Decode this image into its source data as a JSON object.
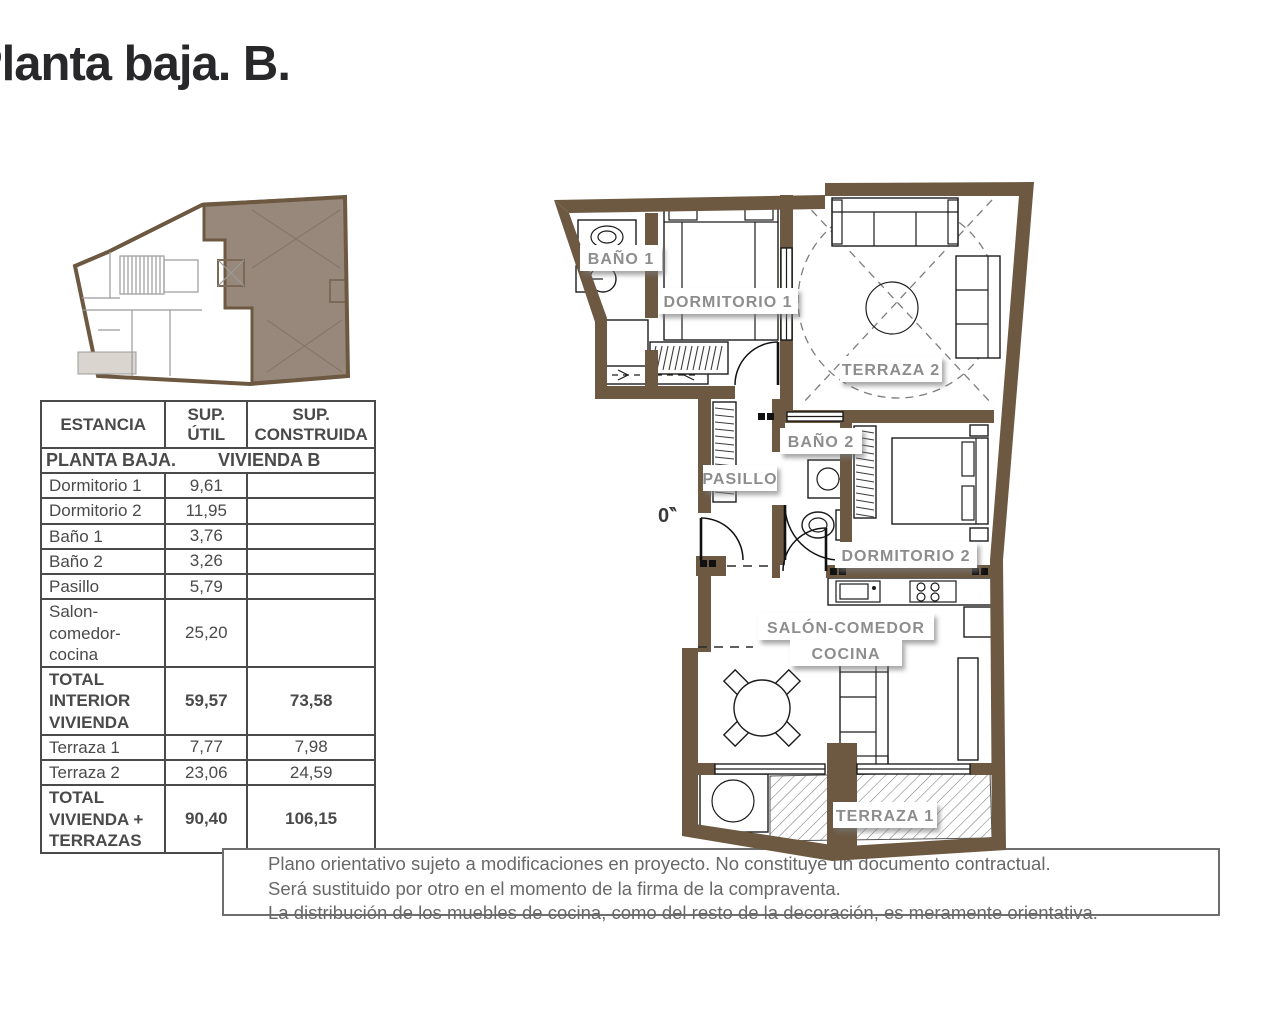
{
  "title": "Planta baja. B.",
  "colors": {
    "wall_brown": "#6d5942",
    "unit_highlight": "#98887b",
    "room_label_gray": "#8d8d8d",
    "table_ink": "#4a4a4a",
    "title_ink": "#28282a",
    "disclaimer_ink": "#686868"
  },
  "table": {
    "headers": {
      "estancia": "ESTANCIA",
      "util": "SUP.\nÚTIL",
      "construida": "SUP.\nCONSTRUIDA"
    },
    "section_title": "PLANTA BAJA.",
    "section_subtitle": "VIVIENDA B",
    "rows": [
      {
        "estancia": "Dormitorio 1",
        "util": "9,61",
        "construida": ""
      },
      {
        "estancia": "Dormitorio 2",
        "util": "11,95",
        "construida": ""
      },
      {
        "estancia": "Baño 1",
        "util": "3,76",
        "construida": ""
      },
      {
        "estancia": "Baño 2",
        "util": "3,26",
        "construida": ""
      },
      {
        "estancia": "Pasillo",
        "util": "5,79",
        "construida": ""
      },
      {
        "estancia": "Salon-\ncomedor-\ncocina",
        "util": "25,20",
        "construida": ""
      },
      {
        "estancia": "TOTAL\nINTERIOR\nVIVIENDA",
        "util": "59,57",
        "construida": "73,58"
      },
      {
        "estancia": "Terraza 1",
        "util": "7,77",
        "construida": "7,98"
      },
      {
        "estancia": "Terraza 2",
        "util": "23,06",
        "construida": "24,59"
      },
      {
        "estancia": "TOTAL\nVIVIENDA +\nTERRAZAS",
        "util": "90,40",
        "construida": "106,15"
      }
    ]
  },
  "plan": {
    "rooms": {
      "bano1": "BAÑO 1",
      "dormitorio1": "DORMITORIO 1",
      "terraza2": "TERRAZA 2",
      "bano2": "BAÑO 2",
      "pasillo": "PASILLO",
      "dormitorio2": "DORMITORIO 2",
      "salon_line1": "SALÓN-COMEDOR",
      "salon_line2": "COCINA",
      "terraza1": "TERRAZA 1"
    },
    "fragment": "0‶"
  },
  "disclaimer": {
    "line1": "Plano orientativo sujeto a modificaciones en proyecto. No constituye un documento contractual.",
    "line2": "Será sustituido por otro en el momento de la firma de la compraventa.",
    "line3": "La distribución de los muebles de cocina, como del resto de la decoración, es meramente orientativa."
  }
}
